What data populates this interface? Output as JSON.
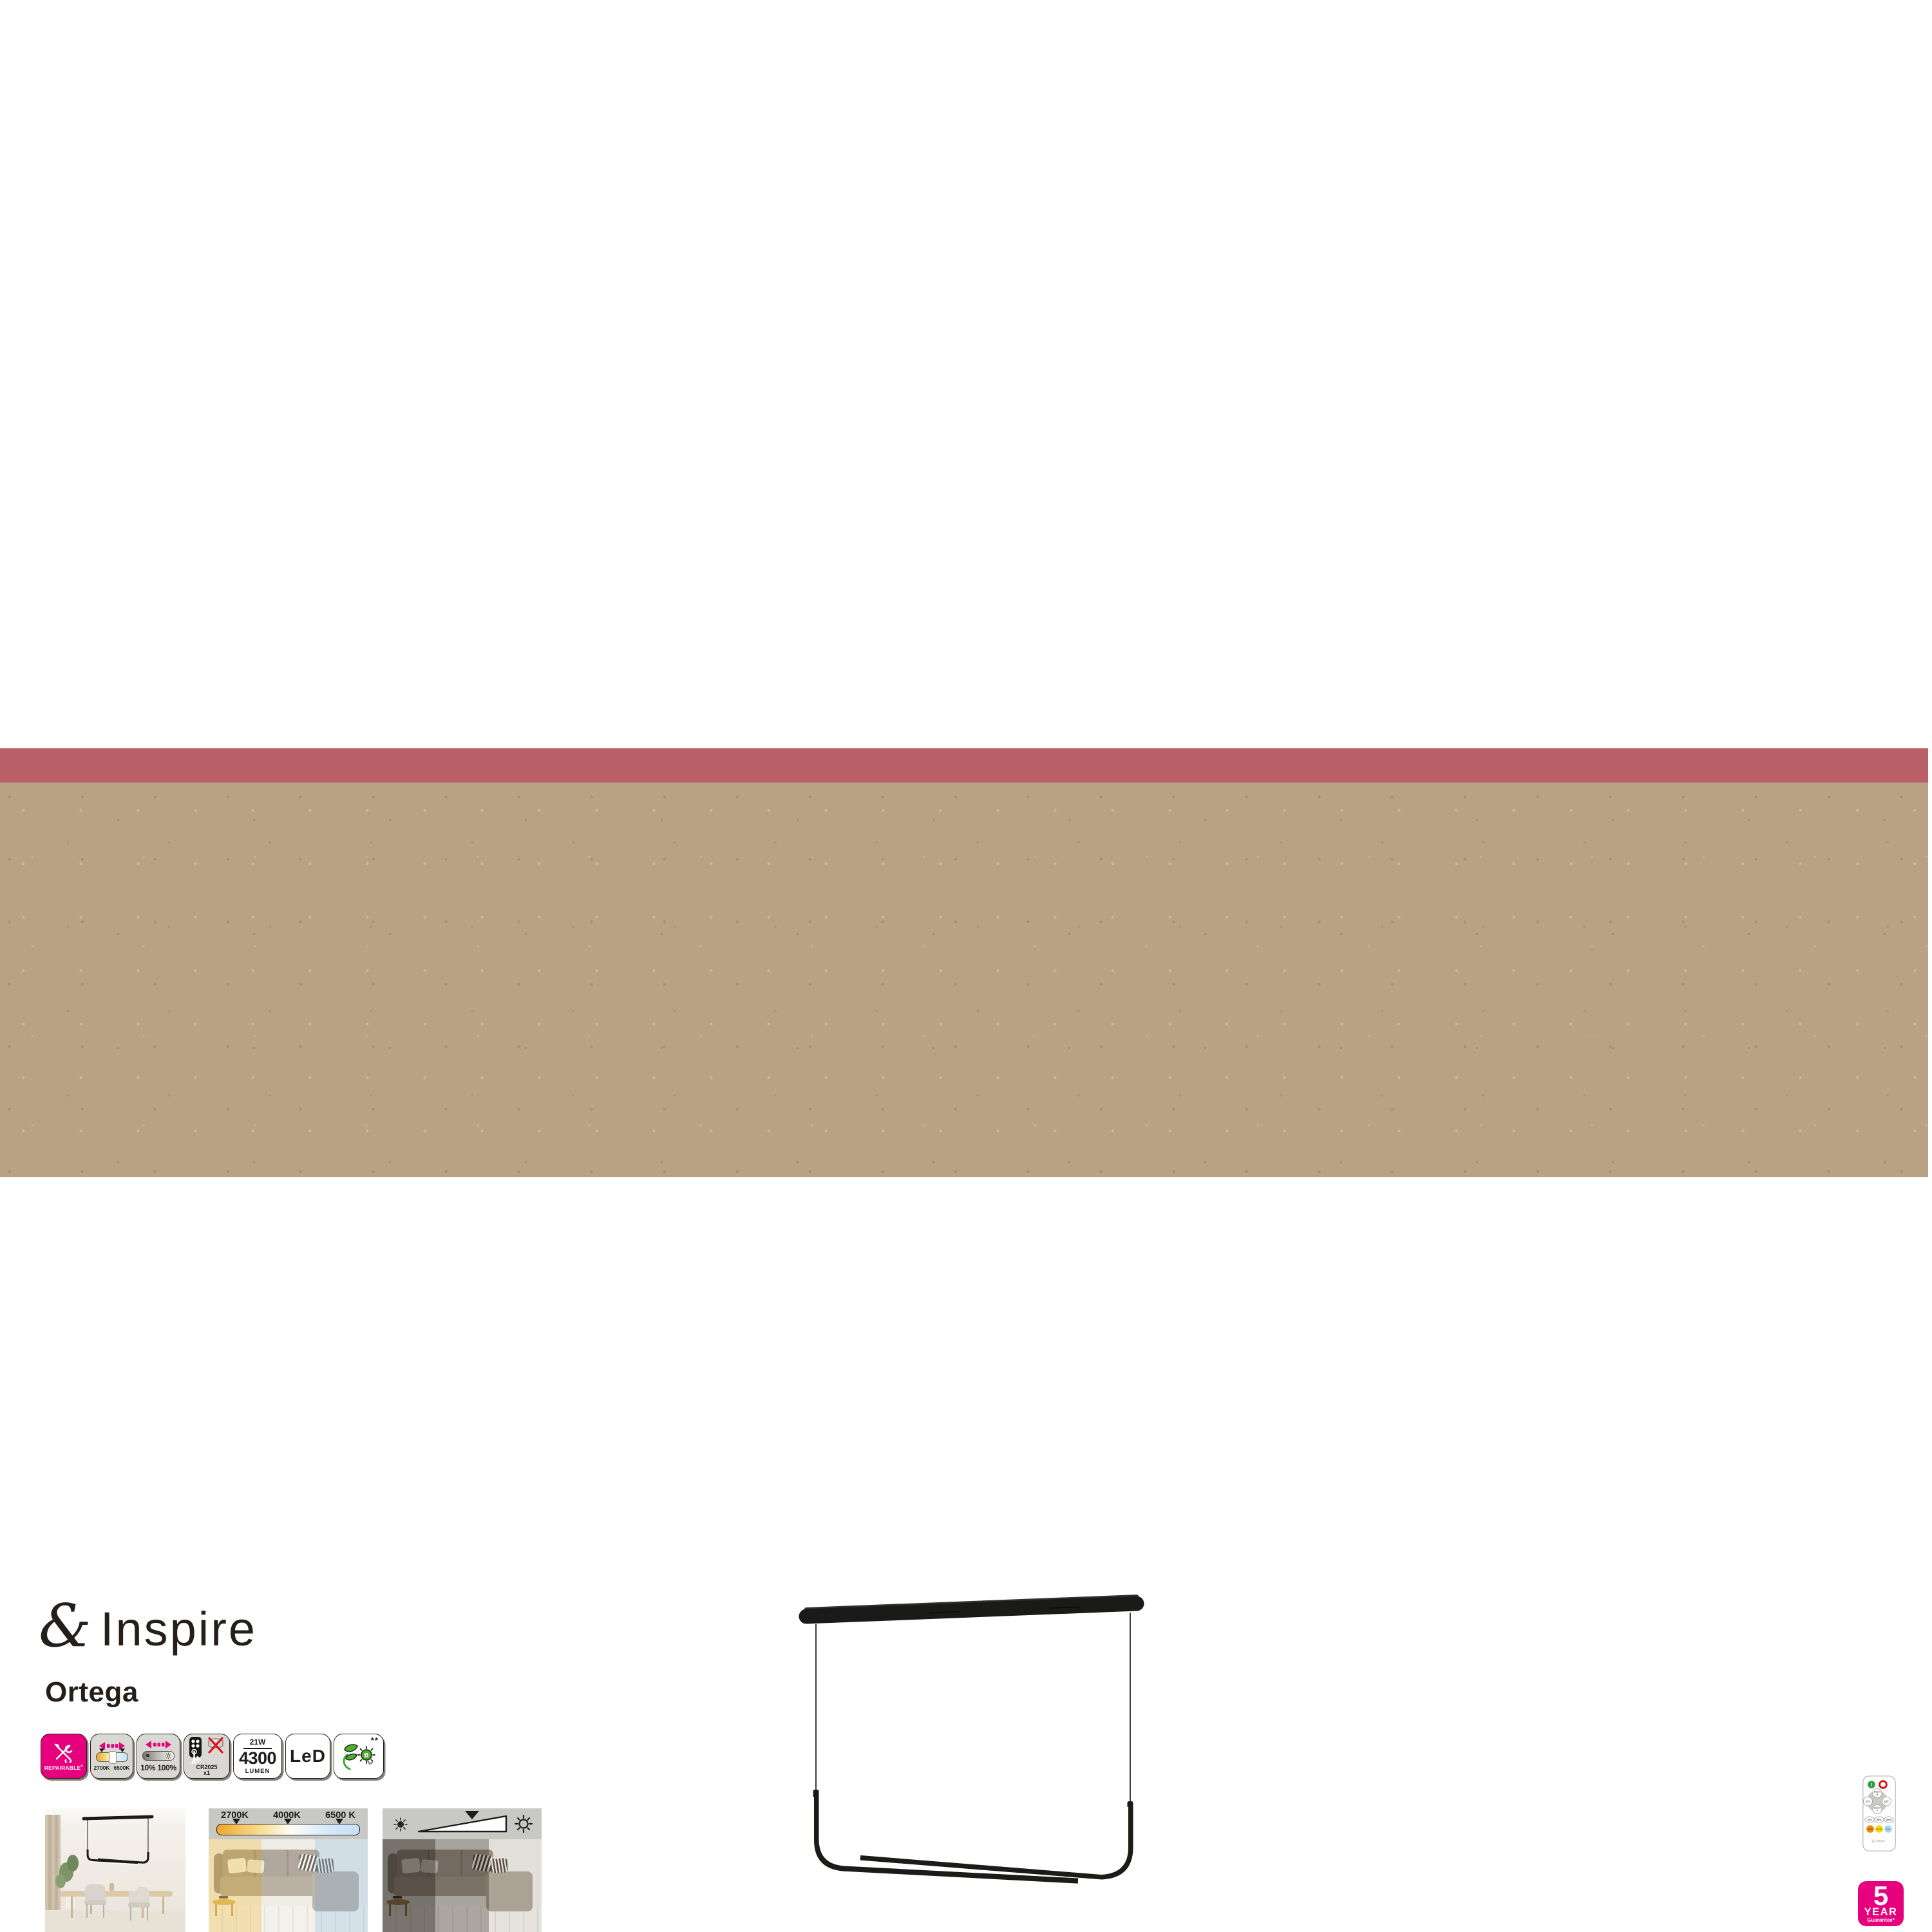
{
  "brand": {
    "ampersand": "&",
    "name": "Inspire"
  },
  "product": {
    "name": "Ortega"
  },
  "colors": {
    "stripe": "#b85f68",
    "kraft_panel": "#b9a284",
    "accent_magenta": "#e6007e",
    "eco_green": "#3fa535",
    "lamp_black": "#1b1b1a"
  },
  "badges": {
    "repairable": {
      "label": "REPAIRABLE",
      "reg": "®",
      "icon": "wrench-screwdriver"
    },
    "cct": {
      "min": "2700K",
      "max": "6500K",
      "icon": "color-temperature-slider"
    },
    "dimming": {
      "min": "10%",
      "max": "100%",
      "icon": "dimmer-slider"
    },
    "battery": {
      "model": "CR2025",
      "qty": "x1",
      "icon": "remote-and-coin-cell-not-included"
    },
    "power": {
      "watt": "21W",
      "lumen_value": "4300",
      "lumen_label": "LUMEN"
    },
    "led": {
      "label": "LeD"
    },
    "eco": {
      "stars": "**",
      "bulb_letter": "B",
      "icon": "leaf-bulb"
    }
  },
  "photos": {
    "room": {
      "description": "pendant-over-dining-table"
    },
    "cct_demo": {
      "warm": "2700K",
      "neutral": "4000K",
      "cool": "6500 K"
    },
    "dim_demo": {
      "description": "dimming-wedge-suns"
    }
  },
  "remote": {
    "power_on": "I",
    "brightness_up_line1": "BRIGHT",
    "brightness_up_line2": "+",
    "brightness_down_line1": "BRIGHT",
    "brightness_down_line2": "−",
    "ct_left": "C/T",
    "ct_right": "C/T",
    "preset_10": "10%",
    "preset_50": "50%",
    "preset_100": "100%",
    "warm": "WARM",
    "neutral": "NEUTRAL",
    "cold": "COLD",
    "brand": "Inspire"
  },
  "guarantee": {
    "number": "5",
    "year": "YEAR",
    "text": "Guarantee*"
  }
}
